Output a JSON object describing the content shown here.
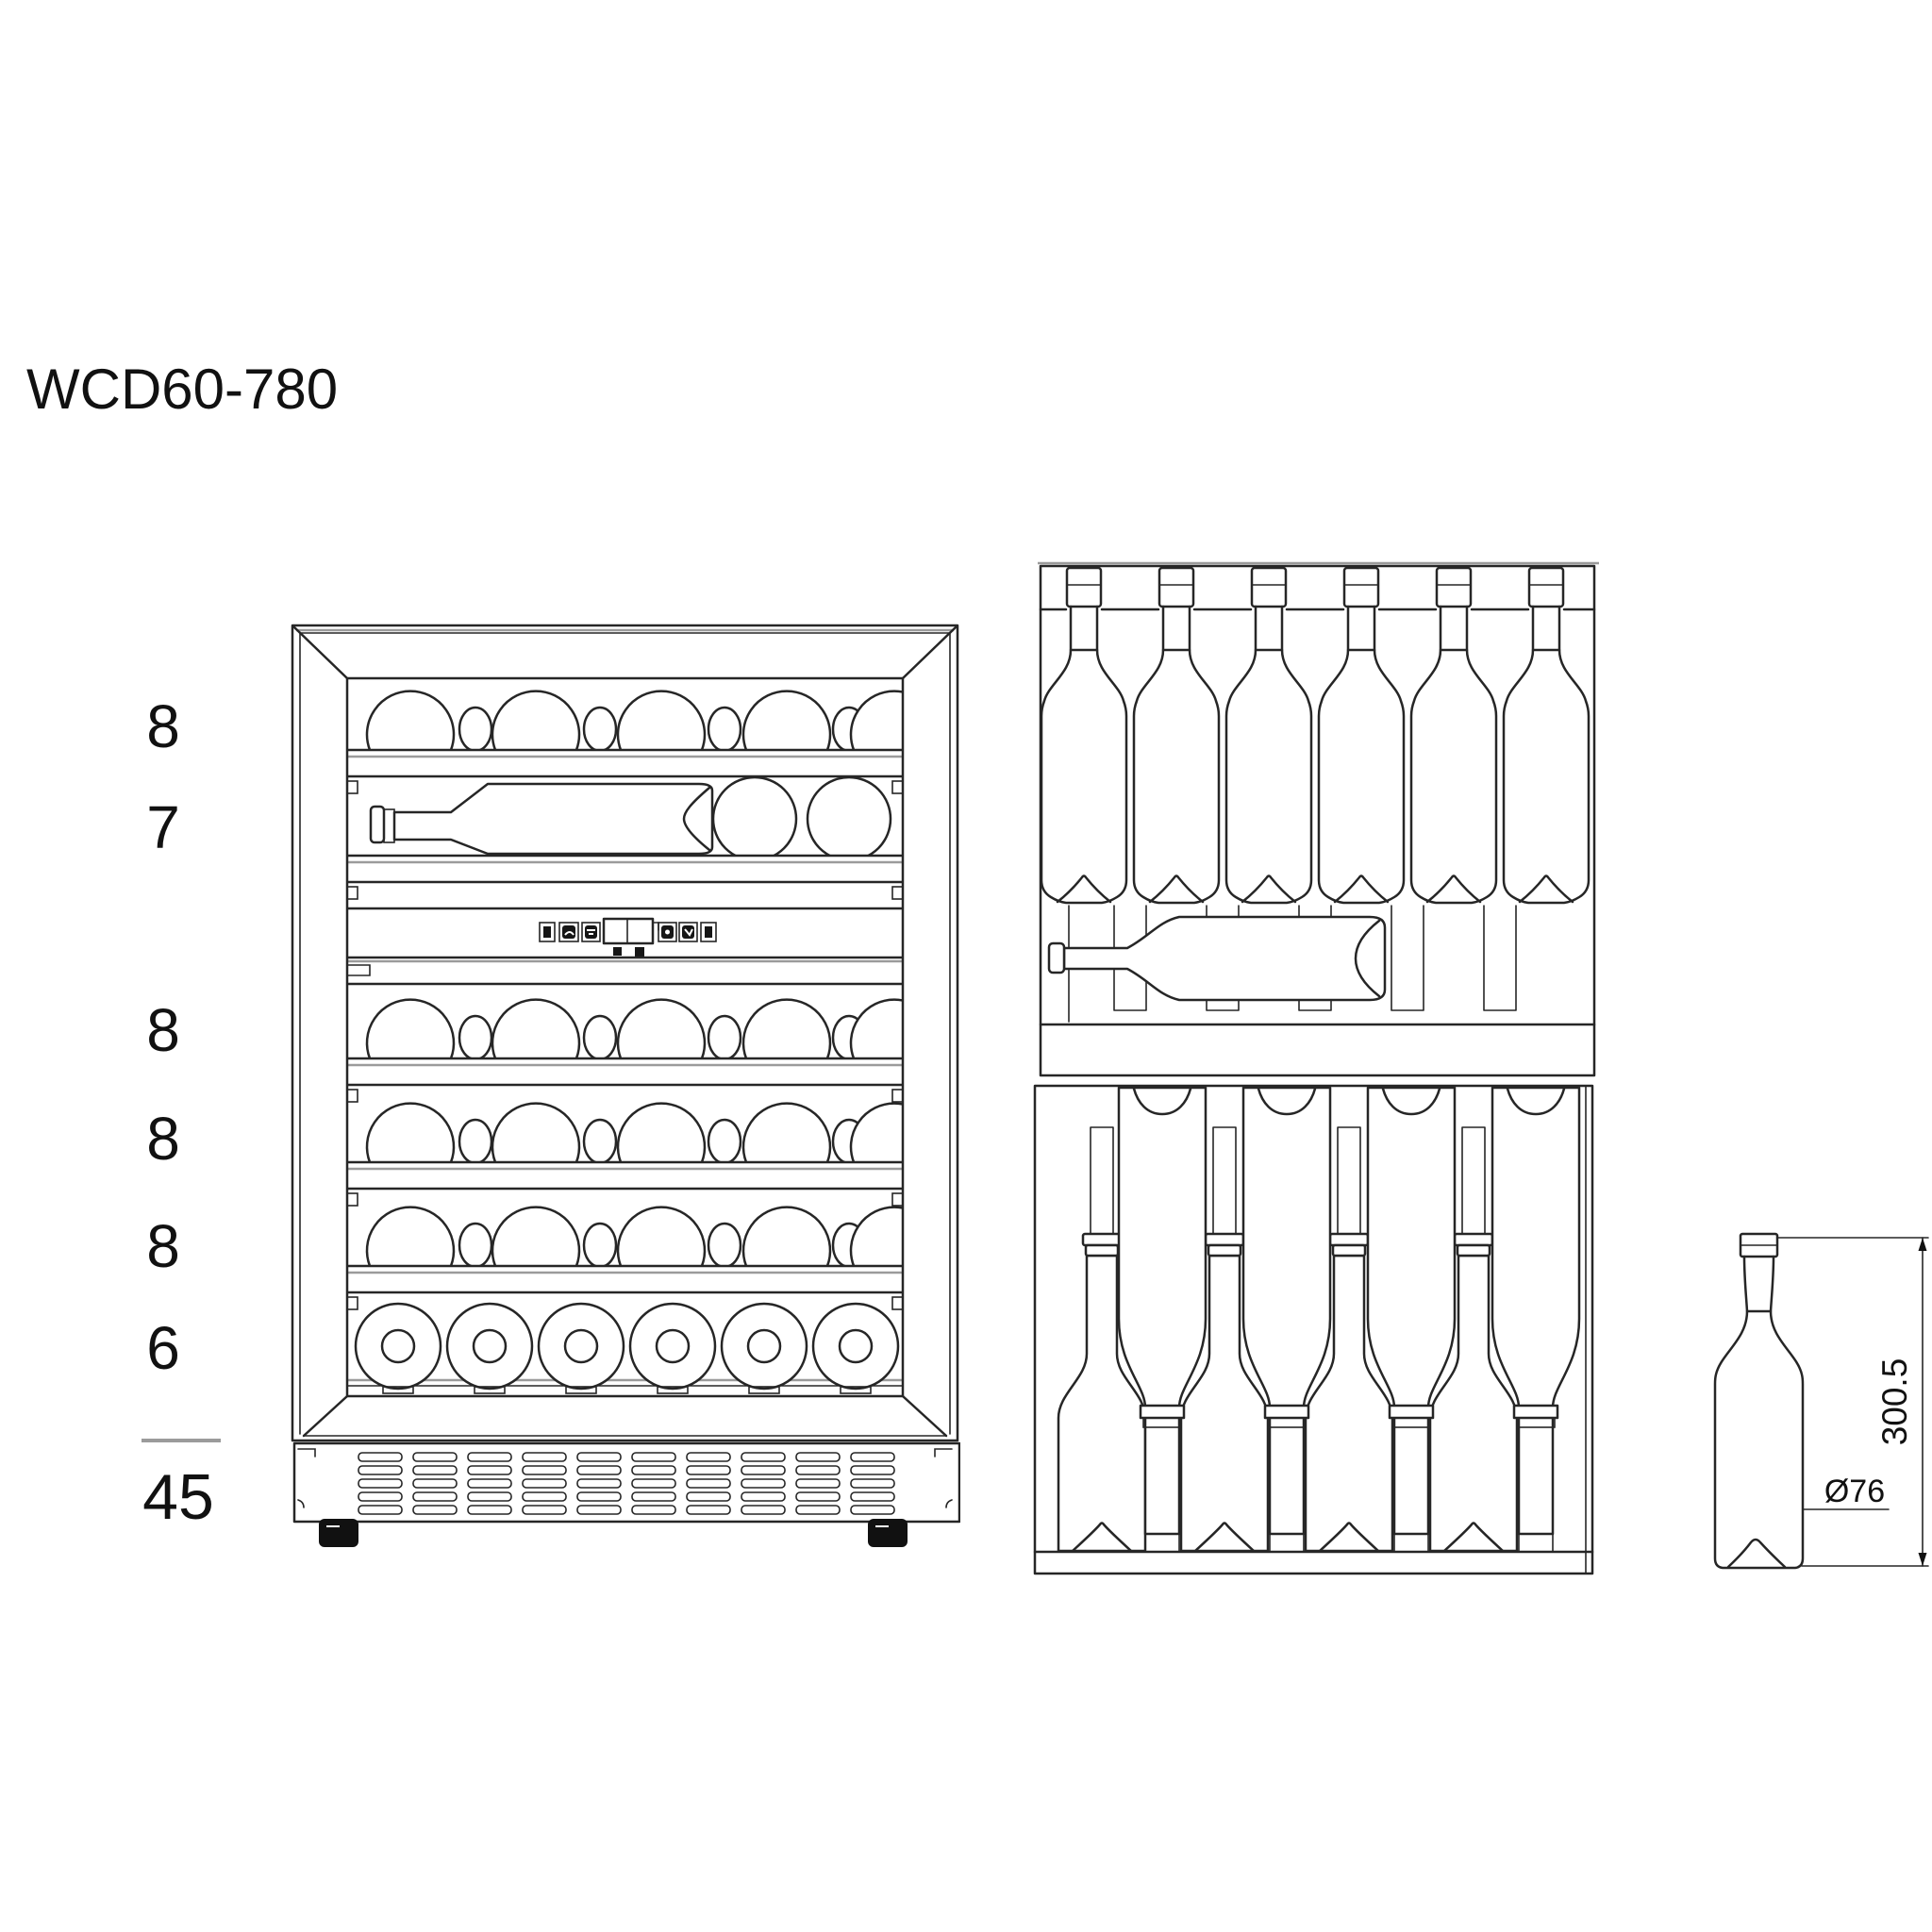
{
  "title": "WCD60-780",
  "left_column": {
    "shelf_counts": [
      "8",
      "7",
      "8",
      "8",
      "8",
      "6"
    ],
    "total": "45"
  },
  "bottle_dimensions": {
    "height": "300.5",
    "diameter": "Ø76"
  },
  "colors": {
    "line": "#262626",
    "gray_line": "#9b9b9b",
    "background": "#ffffff",
    "text": "#111111"
  }
}
